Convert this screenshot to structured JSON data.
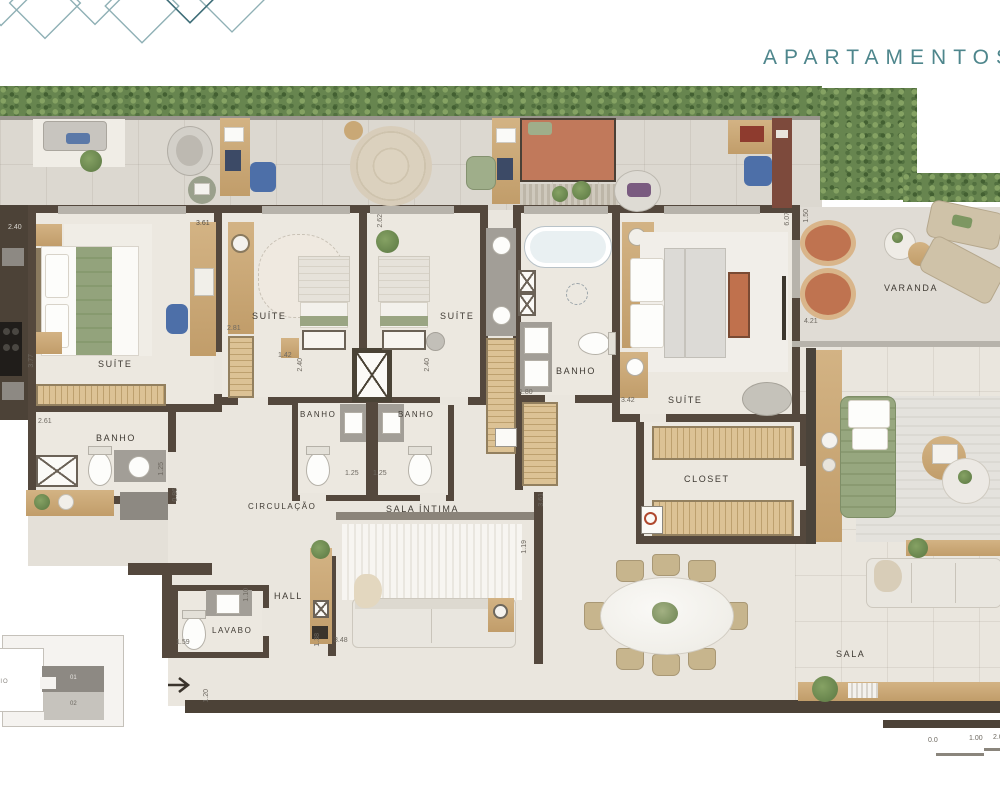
{
  "header": {
    "title": "APARTAMENTOS CO"
  },
  "rooms": {
    "suite_left": "SUÍTE",
    "banho_left": "BANHO",
    "suite_mid1": "SUÍTE",
    "banho_mid1": "BANHO",
    "suite_mid2": "SUÍTE",
    "banho_mid2": "BANHO",
    "banho_master": "BANHO",
    "suite_master": "SUÍTE",
    "closet": "CLOSET",
    "varanda": "VARANDA",
    "sala": "SALA",
    "sala_intima": "SALA ÍNTIMA",
    "circulacao": "CIRCULAÇÃO",
    "hall": "HALL",
    "lavabo": "LAVABO"
  },
  "dims": {
    "suite_left_top": "2.40",
    "suite_left_width": "3.61",
    "suite_left_height": "3.77",
    "banho_left_width": "2.61",
    "banho_left_depth": "1.25",
    "corridor_width": "0.86",
    "suite_mid1_left": "2.81",
    "suite_mid1_gap": "1.42",
    "banho_mid1_h": "2.40",
    "banho_mid2_h": "2.40",
    "suite_mid2_top": "2.62",
    "banho_mid1_w": "1.25",
    "banho_mid2_w": "1.25",
    "banho_master_w": "1.80",
    "suite_master_w": "3.42",
    "suite_master_d": "6.07",
    "varanda_d": "1.50",
    "varanda_w": "4.21",
    "lavabo_w": "1.59",
    "lavabo_d": "1.10",
    "sala_intima_left": "1.38",
    "sala_intima_w": "3.48",
    "sala_intima_right": "3.61",
    "hall_passage": "1.19",
    "entry_w": "1.20"
  },
  "keyplan": {
    "unit_top": "01",
    "unit_bottom": "02",
    "side_label": "RIO"
  },
  "scalebar": {
    "t0": "0.0",
    "t1": "1.00",
    "t2": "2.00"
  },
  "palette": {
    "title_teal": "#4e868c",
    "wall": "#54483d",
    "wood": "#c9a876",
    "hedge_green": "#67854f",
    "terracotta": "#bf7350",
    "sofa_green": "#97a77f",
    "accent_blue": "#4d6fa8"
  }
}
